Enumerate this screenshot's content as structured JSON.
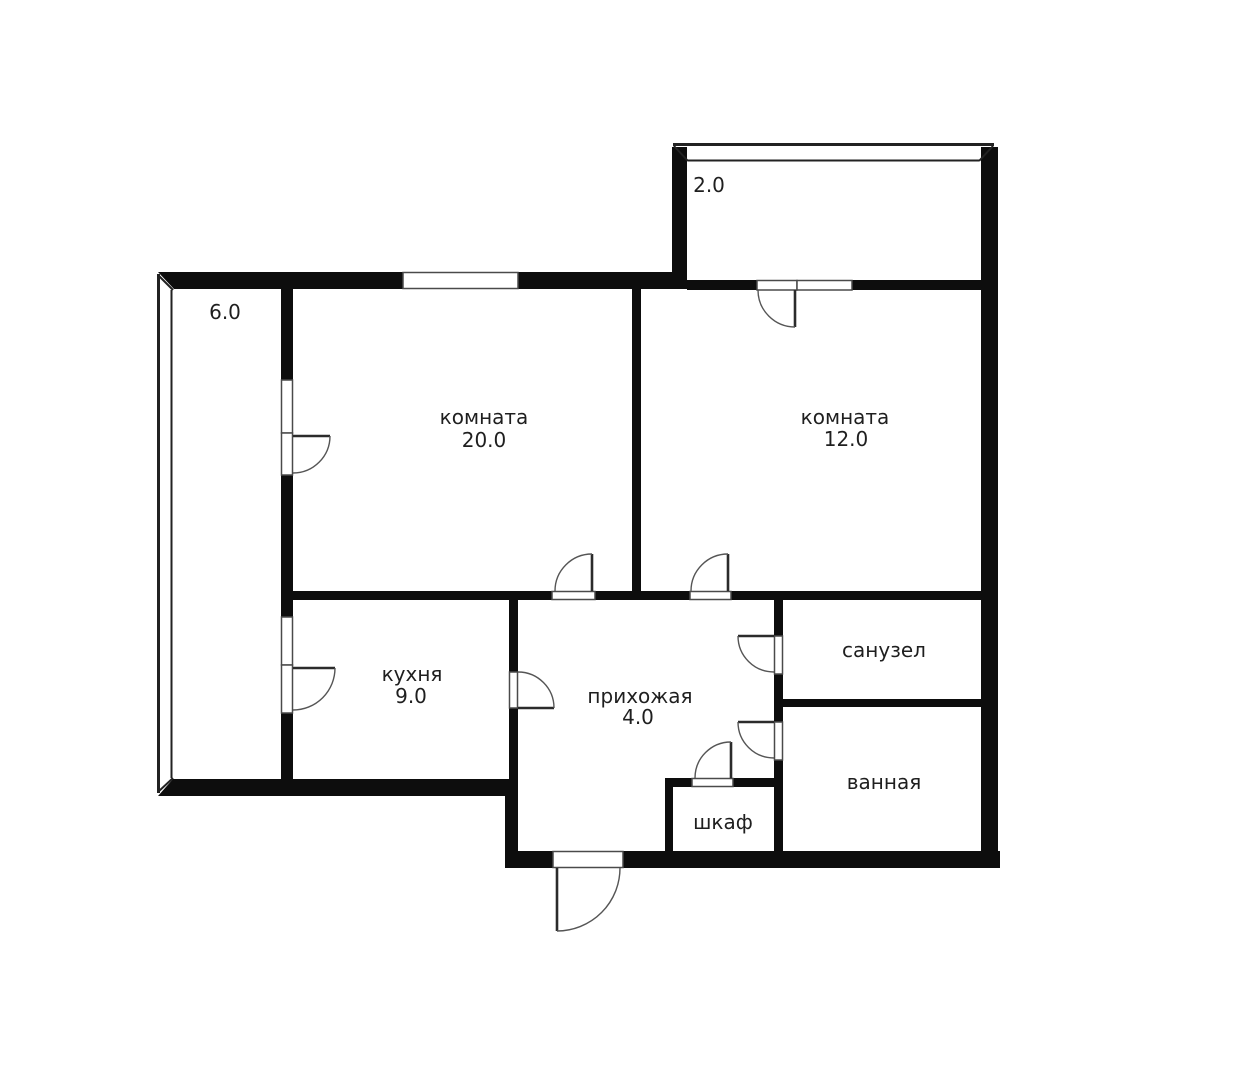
{
  "plan": {
    "rooms": [
      {
        "name": "комната",
        "area": "20.0"
      },
      {
        "name": "комната",
        "area": "12.0"
      },
      {
        "name": "кухня",
        "area": "9.0"
      },
      {
        "name": "прихожая",
        "area": "4.0"
      },
      {
        "name": "санузел"
      },
      {
        "name": "ванная"
      },
      {
        "name": "шкаф"
      }
    ],
    "balconies": [
      {
        "area": "6.0"
      },
      {
        "area": "2.0"
      }
    ],
    "colors": {
      "wall": "#0d0d0d",
      "door_arc": "#555555",
      "text": "#1f1f1f",
      "background": "#ffffff"
    }
  }
}
